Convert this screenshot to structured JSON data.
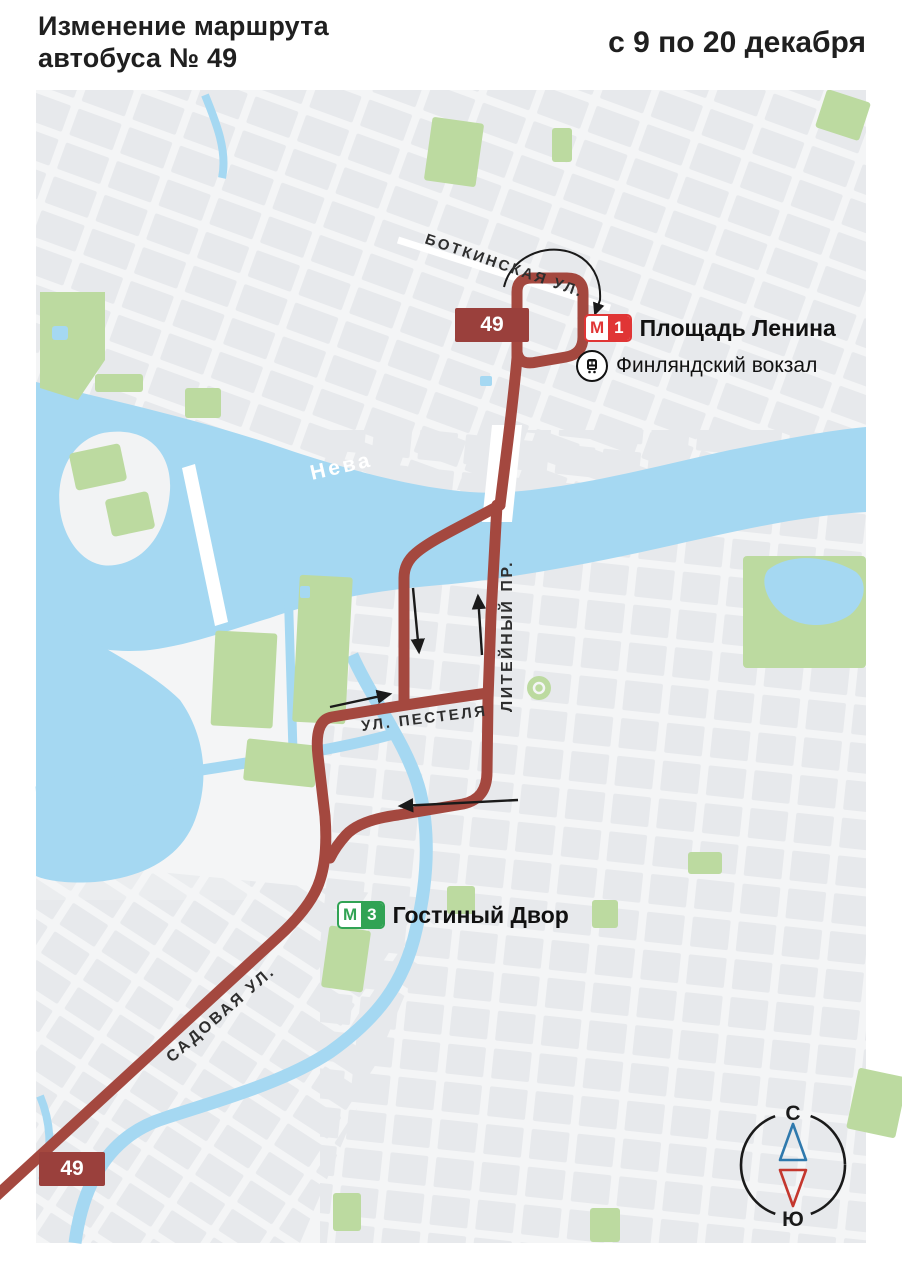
{
  "header": {
    "title_line1": "Изменение маршрута",
    "title_line2": "автобуса № 49",
    "dates": "с 9 по 20 декабря"
  },
  "map": {
    "route_badge": "49",
    "river_label": "Нева",
    "streets": {
      "botkinskaya": "БОТКИНСКАЯ УЛ.",
      "liteyny": "ЛИТЕЙНЫЙ ПР.",
      "pestelya": "УЛ. ПЕСТЕЛЯ",
      "sadovaya": "САДОВАЯ УЛ."
    },
    "stations": {
      "ploshchad_lenina": {
        "metro_logo": "М",
        "line_number": "1",
        "name": "Площадь Ленина"
      },
      "finlyandsky": {
        "name": "Финляндский вокзал"
      },
      "gostiny_dvor": {
        "metro_logo": "М",
        "line_number": "3",
        "name": "Гостиный Двор"
      }
    },
    "compass": {
      "north_label": "С",
      "south_label": "Ю"
    },
    "colors": {
      "route": "#a4483f",
      "route_badge": "#9a403c",
      "metro_line1": "#e03535",
      "metro_line3": "#31a354",
      "water": "#a5d8f2",
      "park": "#bcdaa0",
      "compass_north": "#2f79ad",
      "compass_south": "#c4372e"
    }
  }
}
